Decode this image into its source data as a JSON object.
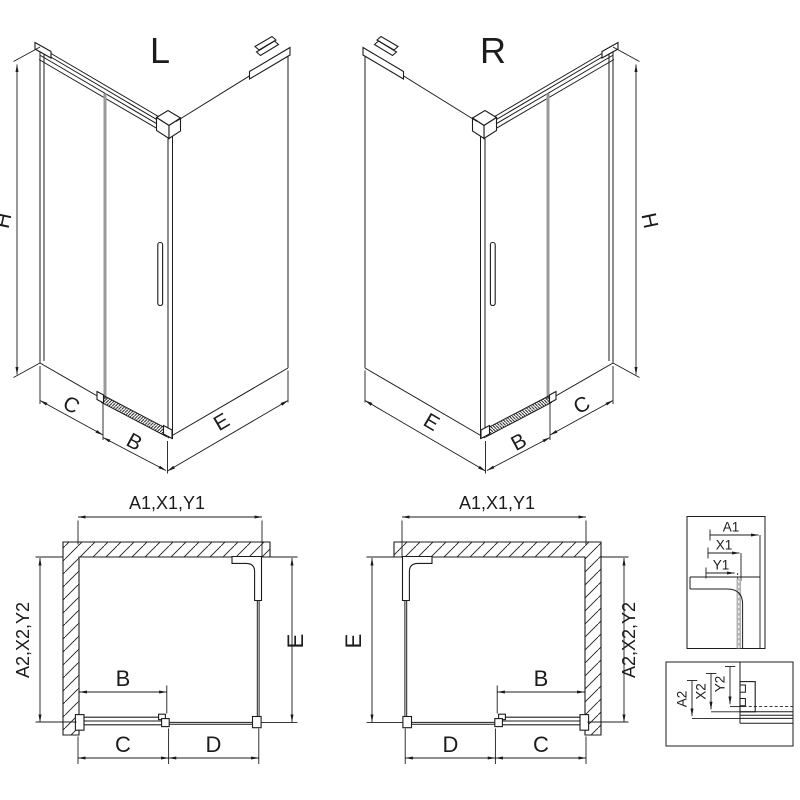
{
  "drawing": {
    "colors": {
      "line": "#1c1c1c",
      "glass_edge": "#9a9a9a",
      "detail_glass": "#b3b3b3",
      "background": "#ffffff"
    },
    "iso_left": {
      "label": "L",
      "height": "H",
      "panel": "C",
      "door": "B",
      "side": "E"
    },
    "iso_right": {
      "label": "R",
      "height": "H",
      "panel": "C",
      "door": "B",
      "side": "E"
    },
    "plan_left": {
      "width_top": "A1,X1,Y1",
      "depth_side": "A2,X2,Y2",
      "depth_glass": "E",
      "door": "B",
      "entry": "C",
      "fixed": "D"
    },
    "plan_right": {
      "width_top": "A1,X1,Y1",
      "depth_side": "A2,X2,Y2",
      "depth_glass": "E",
      "door": "B",
      "entry": "C",
      "fixed": "D"
    },
    "detail_profile": {
      "dims": [
        "A1",
        "X1",
        "Y1"
      ]
    },
    "detail_rail": {
      "dims": [
        "A2",
        "X2",
        "Y2"
      ]
    }
  }
}
